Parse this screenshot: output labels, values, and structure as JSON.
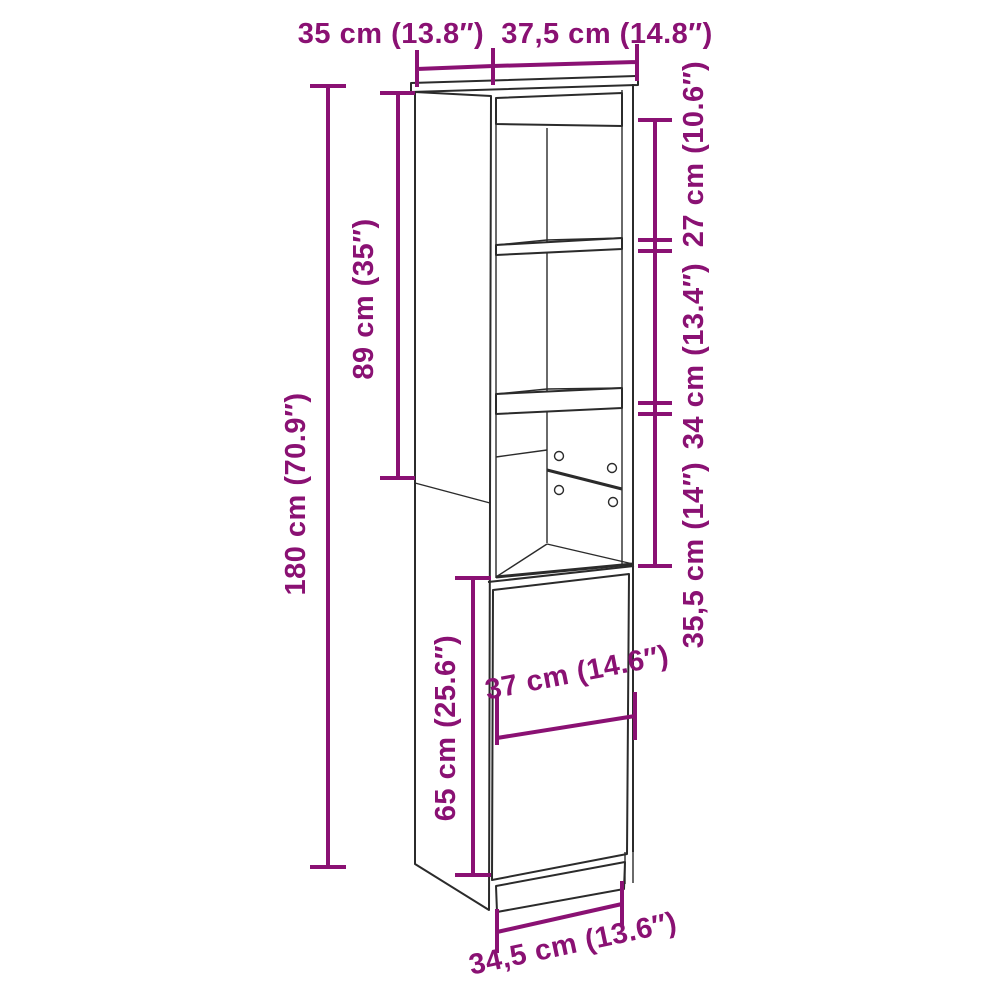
{
  "diagram": {
    "type": "furniture-dimension-drawing",
    "subject": "tall-cabinet-with-open-shelves-and-door",
    "dimensions": {
      "top_depth": {
        "label": "35 cm (13.8″)"
      },
      "top_width": {
        "label": "37,5 cm (14.8″)"
      },
      "total_height": {
        "label": "180 cm (70.9″)"
      },
      "upper_height": {
        "label": "89 cm (35″)"
      },
      "niche_top": {
        "label": "27 cm (10.6″)"
      },
      "niche_middle": {
        "label": "34 cm (13.4″)"
      },
      "niche_bottom": {
        "label": "35,5 cm (14″)"
      },
      "door_width": {
        "label": "37 cm (14.6″)"
      },
      "door_height": {
        "label": "65 cm (25.6″)"
      },
      "base_width": {
        "label": "34,5 cm (13.6″)"
      }
    },
    "colors": {
      "dimension_accent": "#8A1173",
      "drawing_line": "#2b2b2b",
      "background": "#ffffff"
    }
  }
}
